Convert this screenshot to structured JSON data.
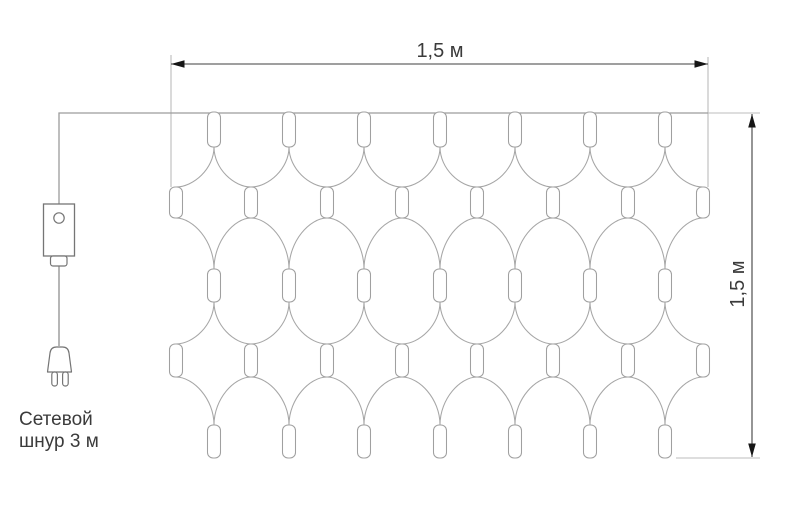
{
  "labels": {
    "width_dimension": "1,5 м",
    "height_dimension": "1,5 м",
    "cord_line1": "Сетевой",
    "cord_line2": "шнур 3 м"
  },
  "colors": {
    "background": "#ffffff",
    "net_line": "#a6a6a6",
    "lamp_stroke": "#a0a0a0",
    "lamp_fill": "#ffffff",
    "top_wire": "#9c9c9c",
    "cord_line": "#8e8e8e",
    "device_stroke": "#757575",
    "extension_line": "#bcbcbc",
    "dimension_line": "#3f3f3f",
    "arrow_fill": "#161616",
    "text": "#3b3b3b"
  },
  "net": {
    "top_wire_y": 113,
    "wire_start_x": 58,
    "left_edge_x": 171,
    "right_edge_x": 708,
    "lamp_w": 13,
    "top_xs": [
      214,
      289,
      364,
      440,
      515,
      590,
      665
    ],
    "side_xs": [
      176,
      251,
      327,
      402,
      477,
      553,
      628,
      703
    ],
    "rows": [
      {
        "kind": "top",
        "y": 112,
        "h": 35
      },
      {
        "kind": "side",
        "y": 187,
        "h": 31
      },
      {
        "kind": "top",
        "y": 269,
        "h": 33
      },
      {
        "kind": "side",
        "y": 344,
        "h": 33
      },
      {
        "kind": "top",
        "y": 425,
        "h": 33
      }
    ]
  },
  "dimensions": {
    "top": {
      "line_y": 64,
      "x1": 171,
      "x2": 708,
      "label_x": 440,
      "label_y": 57
    },
    "right": {
      "line_x": 752,
      "y1": 114,
      "y2": 457,
      "label_x": 744,
      "label_y": 284
    }
  }
}
